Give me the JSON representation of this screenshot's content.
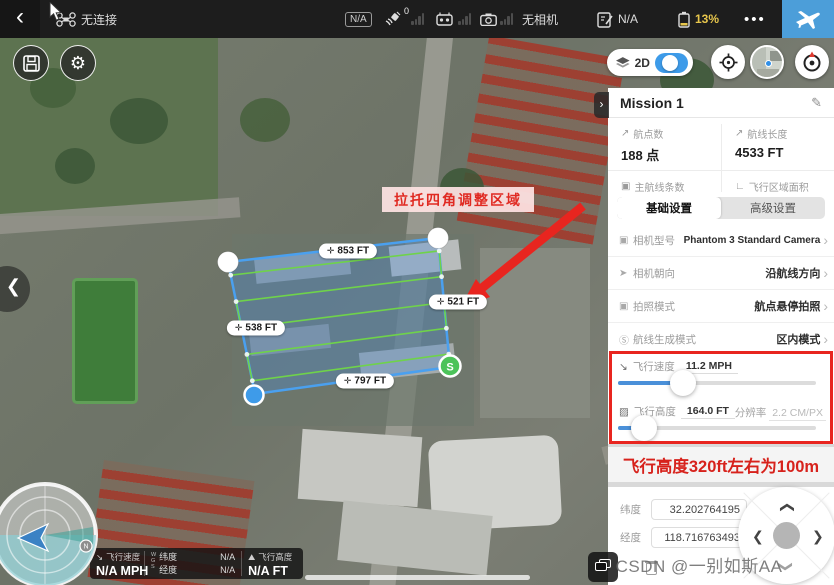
{
  "topbar": {
    "back_glyph": "‹",
    "connection": "无连接",
    "na_badge": "N/A",
    "gps_count": "0",
    "camera_status": "无相机",
    "checklist_status": "N/A",
    "battery": "13%",
    "more_glyph": "•••"
  },
  "map_overlay": {
    "mode_label": "2D",
    "edge_labels": {
      "top": "853 FT",
      "right": "521 FT",
      "left": "538 FT",
      "bottom": "797 FT"
    },
    "start_marker": "S",
    "annotation": "拉托四角调整区域",
    "compass_north": "N"
  },
  "panel": {
    "title": "Mission 1",
    "stats": [
      {
        "label": "航点数",
        "value": "188 点"
      },
      {
        "label": "航线长度",
        "value": "4533 FT"
      },
      {
        "label": "主航线条数",
        "value": "5 条"
      },
      {
        "label": "飞行区域面积",
        "value": "10.02 ACRE"
      }
    ],
    "tabs": [
      {
        "label": "基础设置"
      },
      {
        "label": "高级设置"
      }
    ],
    "settings": [
      {
        "label": "相机型号",
        "value": "Phantom 3 Standard Camera"
      },
      {
        "label": "相机朝向",
        "value": "沿航线方向"
      },
      {
        "label": "拍照模式",
        "value": "航点悬停拍照"
      },
      {
        "label": "航线生成模式",
        "value": "区内模式"
      }
    ],
    "sliders": [
      {
        "label": "飞行速度",
        "value": "11.2 MPH",
        "percent": 33
      },
      {
        "label": "飞行高度",
        "value": "164.0 FT",
        "extra_label": "分辨率",
        "extra_value": "2.2 CM/PX",
        "percent": 13
      }
    ],
    "note": "飞行高度320ft左右为100m",
    "coords": [
      {
        "label": "纬度",
        "value": "32.202764195"
      },
      {
        "label": "经度",
        "value": "118.716763493"
      }
    ]
  },
  "telemetry": {
    "speed_label": "飞行速度",
    "speed_value": "N/A MPH",
    "wgs": "WGS",
    "lat_label": "纬度",
    "lat_value": "N/A",
    "lon_label": "经度",
    "lon_value": "N/A",
    "alt_label": "飞行高度",
    "alt_value": "N/A FT"
  },
  "watermark": "CSDN @一别如斯AA",
  "colors": {
    "accent_blue": "#4C9ED9",
    "alert_red": "#E8251F",
    "battery_yellow": "#E7C64C",
    "polygon_blue": "#4AA0EF",
    "route_green": "#6FD34A"
  }
}
